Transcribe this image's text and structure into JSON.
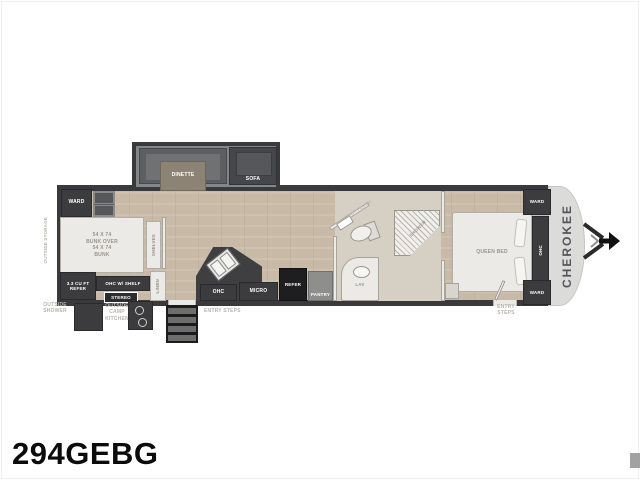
{
  "page": {
    "model_number": "294GEBG",
    "brand_vertical": "CHEROKEE"
  },
  "colors": {
    "wall_dark": "#3a3a3c",
    "floor_tan": "#c8baa7",
    "front_cap": "#dbdbd9",
    "accent_black": "#1e1e20",
    "outline_label": "#b7b5b0"
  },
  "floorplan": {
    "slideout": {
      "dinette_label": "DINETTE",
      "sofa_label": "SOFA"
    },
    "bunk_room": {
      "wardrobe_label": "WARD",
      "bunk_lines": [
        "54 X 74",
        "BUNK OVER",
        "54 X 74",
        "BUNK"
      ],
      "refer_line1": "3.3 CU FT",
      "refer_line2": "REFER",
      "ohc_shelf_label": "OHC W/ SHELF",
      "stereo_label": "STEREO",
      "shelves_label": "SHELVES",
      "linen_label": "LINEN"
    },
    "kitchen": {
      "ohc_label": "OHC",
      "micro_label": "MICRO",
      "refer_label": "REFER",
      "pantry_label": "PANTRY"
    },
    "bathroom": {
      "foot_flush_label": "FOOT FLUSH",
      "lav_label": "LAV",
      "shower_label": "SHOWER"
    },
    "bedroom": {
      "bed_label": "QUEEN BED",
      "ward_top_label": "WARD",
      "ward_bottom_label": "WARD",
      "ohc_label": "OHC"
    },
    "exterior": {
      "rear_storage_label": "OUTSIDE STORAGE",
      "outside_shower_lines": [
        "OUTSIDE",
        "SHOWER"
      ],
      "camp_kitchen_lines": [
        "OUTSIDE",
        "CAMP",
        "KITCHEN"
      ],
      "entry_steps_label": "ENTRY STEPS",
      "entry_steps_lines": [
        "ENTRY",
        "STEPS"
      ]
    }
  }
}
